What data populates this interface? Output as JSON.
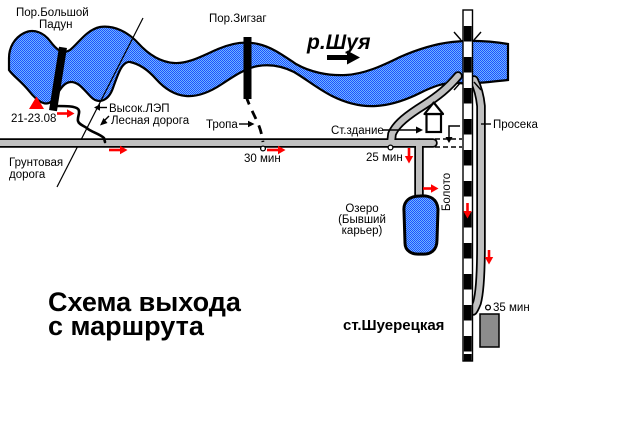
{
  "title": {
    "line1": "Схема выхода",
    "line2": "с маршрута"
  },
  "river": {
    "name": "р.Шуя",
    "rapid1_line1": "Пор.Большой",
    "rapid1_line2": "Падун",
    "rapid2": "Пор.Зигзаг"
  },
  "labels": {
    "camp_dates": "21-23.08",
    "power_line": "Высок.ЛЭП",
    "forest_road": "Лесная дорога",
    "trail": "Тропа",
    "dirt_road_line1": "Грунтовая",
    "dirt_road_line2": "дорога",
    "station_building": "Ст.здание",
    "cutting": "Просека",
    "swamp": "Болото",
    "lake_line1": "Озеро",
    "lake_line2": "(Бывший",
    "lake_line3": "карьер)",
    "station": "ст.Шуерецкая"
  },
  "times": {
    "t30": "30 мин",
    "t25": "25 мин",
    "t35": "35 мин"
  },
  "colors": {
    "water_dark": "#1F4FFF",
    "water_light": "#6EB5FF",
    "road": "#C0C0C0",
    "station_fill": "#8C8C8C",
    "route": "#FF0000"
  }
}
